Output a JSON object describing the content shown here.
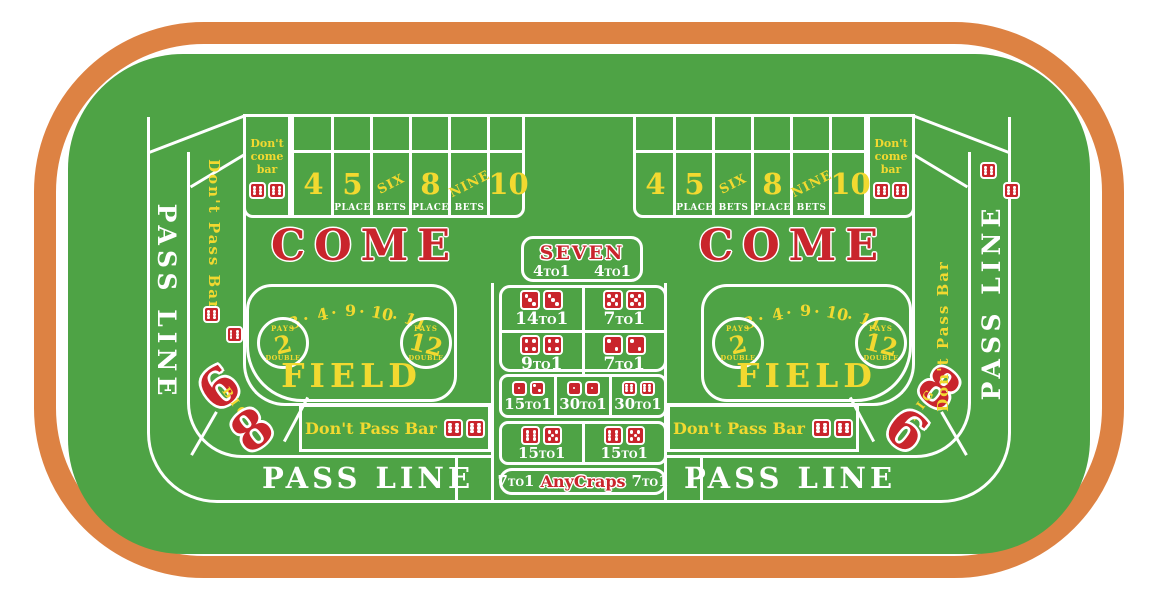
{
  "colors": {
    "felt": "#4ea345",
    "rail": "#dd8243",
    "line": "#ffffff",
    "red": "#c9252c",
    "yellow": "#f2d930"
  },
  "labels": {
    "pass_line": "PASS LINE",
    "dont_pass_bar": "Don't Pass Bar",
    "come": "COME",
    "dont_come": [
      "Don't",
      "come",
      "bar"
    ],
    "big_six": "6",
    "big_mid": "BIG",
    "big_eight": "8",
    "to": "TO",
    "one": "1"
  },
  "bar_dice": [
    6,
    6
  ],
  "place_bets": [
    {
      "num": "4",
      "sub": ""
    },
    {
      "num": "5",
      "sub": "PLACE"
    },
    {
      "num": "SIX",
      "sub": "BETS"
    },
    {
      "num": "8",
      "sub": "PLACE"
    },
    {
      "num": "NINE",
      "sub": "BETS"
    },
    {
      "num": "10",
      "sub": ""
    }
  ],
  "field": {
    "arc_text": "3·4·9·10·11",
    "arc_chars": [
      "3",
      "·",
      "4",
      "·",
      "9",
      "·",
      "10",
      "·",
      "11"
    ],
    "title": "FIELD",
    "circle_left": {
      "top": "PAYS",
      "num": "2",
      "bottom": "DOUBLE"
    },
    "circle_right": {
      "top": "PAYS",
      "num": "12",
      "bottom": "DOUBLE"
    }
  },
  "center": {
    "seven": {
      "title": "SEVEN",
      "left_num": "4",
      "right_num": "4"
    },
    "hardways": [
      {
        "dice": [
          3,
          3
        ],
        "num": "14"
      },
      {
        "dice": [
          5,
          5
        ],
        "num": "7"
      },
      {
        "dice": [
          4,
          4
        ],
        "num": "9"
      },
      {
        "dice": [
          2,
          2
        ],
        "num": "7"
      }
    ],
    "craps_row": [
      {
        "dice": [
          1,
          2
        ],
        "num": "15"
      },
      {
        "dice": [
          1,
          1
        ],
        "num": "30"
      },
      {
        "dice": [
          6,
          6
        ],
        "num": "30"
      }
    ],
    "eleven_row": [
      {
        "dice": [
          6,
          5
        ],
        "num": "15"
      },
      {
        "dice": [
          6,
          5
        ],
        "num": "15"
      }
    ],
    "any_craps": {
      "left_num": "7",
      "title": "AnyCraps",
      "right_num": "7"
    }
  }
}
